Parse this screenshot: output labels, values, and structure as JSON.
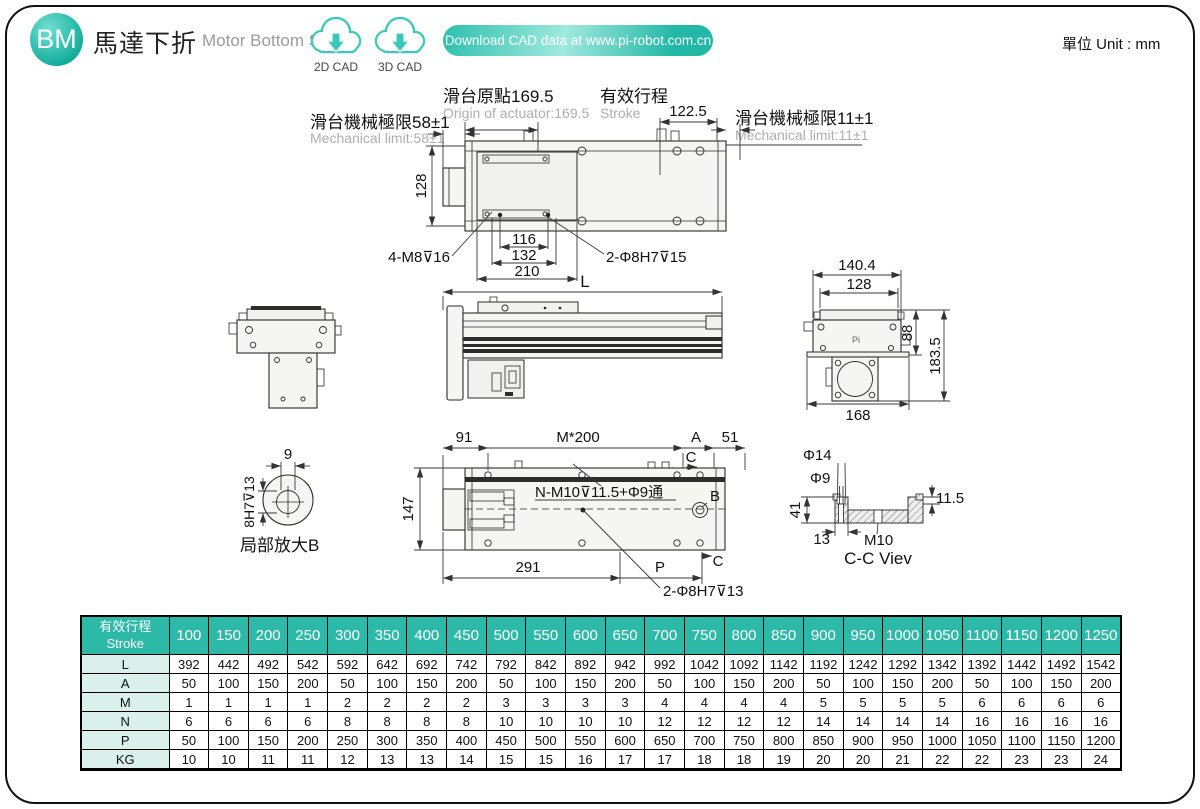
{
  "header": {
    "badge": "BM",
    "title_zh": "馬達下折",
    "title_en": "Motor Bottom Side",
    "cad_2d": "2D CAD",
    "cad_3d": "3D CAD",
    "download_label": "Download CAD data at www.pi-robot.com.cn",
    "unit_label": "單位 Unit : mm"
  },
  "colors": {
    "teal": "#2db9a8",
    "teal_dark": "#12ab9a",
    "teal_light": "#9fe9dd",
    "table_label_bg": "#d9f0eb",
    "gray_text": "#aeaeae"
  },
  "drawing": {
    "top_view": {
      "limit_left_zh": "滑台機械極限58±1",
      "limit_left_en": "Mechanical limit:58±1",
      "origin_zh": "滑台原點169.5",
      "origin_en": "Origin of actuator:169.5",
      "stroke_zh": "有效行程",
      "stroke_en": "Stroke",
      "dim_122_5": "122.5",
      "limit_right_zh": "滑台機械極限11±1",
      "limit_right_en": "Mechanical limit:11±1",
      "dim_128": "128",
      "dim_116": "116",
      "dim_132": "132",
      "dim_210": "210",
      "label_4m8": "4-M8⊽16",
      "label_2phi8h7_15": "2-Φ8H7⊽15"
    },
    "side_view": {
      "dim_L": "L"
    },
    "end_view": {
      "dim_140_4": "140.4",
      "dim_128": "128",
      "dim_88": "88",
      "dim_183_5": "183.5",
      "dim_168": "168",
      "logo": "Pi"
    },
    "bottom_view": {
      "dim_91": "91",
      "dim_m200": "M*200",
      "dim_A": "A",
      "dim_51": "51",
      "label_c_top": "C",
      "label_nm10": "N-M10⊽11.5+Φ9通",
      "label_B": "B",
      "dim_147": "147",
      "dim_291": "291",
      "dim_P": "P",
      "label_c_bottom": "C",
      "label_2phi8h7_13": "2-Φ8H7⊽13"
    },
    "detail_view": {
      "dim_9": "9",
      "dim_8h7_13": "8H7⊽13",
      "caption": "局部放大B"
    },
    "cc_view": {
      "dim_phi14": "Φ14",
      "dim_phi9": "Φ9",
      "dim_41": "41",
      "dim_13": "13",
      "dim_m10": "M10",
      "dim_11_5": "11.5",
      "caption": "C-C Viev"
    }
  },
  "table": {
    "header_label_zh": "有效行程",
    "header_label_en": "Stroke",
    "strokes": [
      "100",
      "150",
      "200",
      "250",
      "300",
      "350",
      "400",
      "450",
      "500",
      "550",
      "600",
      "650",
      "700",
      "750",
      "800",
      "850",
      "900",
      "950",
      "1000",
      "1050",
      "1100",
      "1150",
      "1200",
      "1250"
    ],
    "rows": [
      {
        "label": "L",
        "values": [
          "392",
          "442",
          "492",
          "542",
          "592",
          "642",
          "692",
          "742",
          "792",
          "842",
          "892",
          "942",
          "992",
          "1042",
          "1092",
          "1142",
          "1192",
          "1242",
          "1292",
          "1342",
          "1392",
          "1442",
          "1492",
          "1542"
        ]
      },
      {
        "label": "A",
        "values": [
          "50",
          "100",
          "150",
          "200",
          "50",
          "100",
          "150",
          "200",
          "50",
          "100",
          "150",
          "200",
          "50",
          "100",
          "150",
          "200",
          "50",
          "100",
          "150",
          "200",
          "50",
          "100",
          "150",
          "200"
        ]
      },
      {
        "label": "M",
        "values": [
          "1",
          "1",
          "1",
          "1",
          "2",
          "2",
          "2",
          "2",
          "3",
          "3",
          "3",
          "3",
          "4",
          "4",
          "4",
          "4",
          "5",
          "5",
          "5",
          "5",
          "6",
          "6",
          "6",
          "6"
        ]
      },
      {
        "label": "N",
        "values": [
          "6",
          "6",
          "6",
          "6",
          "8",
          "8",
          "8",
          "8",
          "10",
          "10",
          "10",
          "10",
          "12",
          "12",
          "12",
          "12",
          "14",
          "14",
          "14",
          "14",
          "16",
          "16",
          "16",
          "16"
        ]
      },
      {
        "label": "P",
        "values": [
          "50",
          "100",
          "150",
          "200",
          "250",
          "300",
          "350",
          "400",
          "450",
          "500",
          "550",
          "600",
          "650",
          "700",
          "750",
          "800",
          "850",
          "900",
          "950",
          "1000",
          "1050",
          "1100",
          "1150",
          "1200"
        ]
      },
      {
        "label": "KG",
        "values": [
          "10",
          "10",
          "11",
          "11",
          "12",
          "13",
          "13",
          "14",
          "15",
          "15",
          "16",
          "17",
          "17",
          "18",
          "18",
          "19",
          "20",
          "20",
          "21",
          "22",
          "22",
          "23",
          "23",
          "24"
        ]
      }
    ]
  }
}
